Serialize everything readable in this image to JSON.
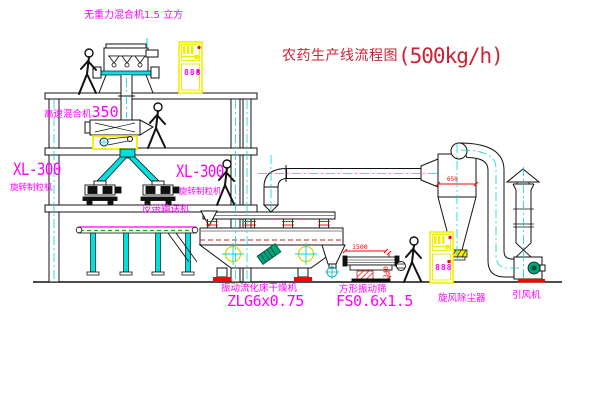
{
  "title": {
    "text": "农药生产线流程图",
    "capacity": "(500kg/h)"
  },
  "labels": {
    "gravity_mixer": "无重力混合机1.5 立方",
    "high_speed_mixer": "高速混合机",
    "high_speed_mixer_model": "350",
    "granulator_left_model": "XL-300",
    "granulator_left": "旋转制粒机",
    "granulator_right_model": "XL-300",
    "granulator_right": "旋转制粒机",
    "belt_conveyor": "皮带输送机",
    "dryer": "振动流化床干燥机",
    "dryer_model": "ZLG6x0.75",
    "screen": "方形振动筛",
    "screen_model": "FS0.6x1.5",
    "cyclone": "旋风除尘器",
    "fan": "引风机"
  },
  "dimensions": {
    "screen_length": "1500",
    "screen_height": "340",
    "cyclone_diameter": "650"
  },
  "control_panel_display": "888",
  "colors": {
    "line": "#111111",
    "magenta": "#ff00ff",
    "red": "#ff0000",
    "title_red": "#cc2233",
    "cyan": "#00d8d8",
    "yellow": "#f2ee00",
    "green": "#00bb00",
    "teal": "#00a37a"
  }
}
